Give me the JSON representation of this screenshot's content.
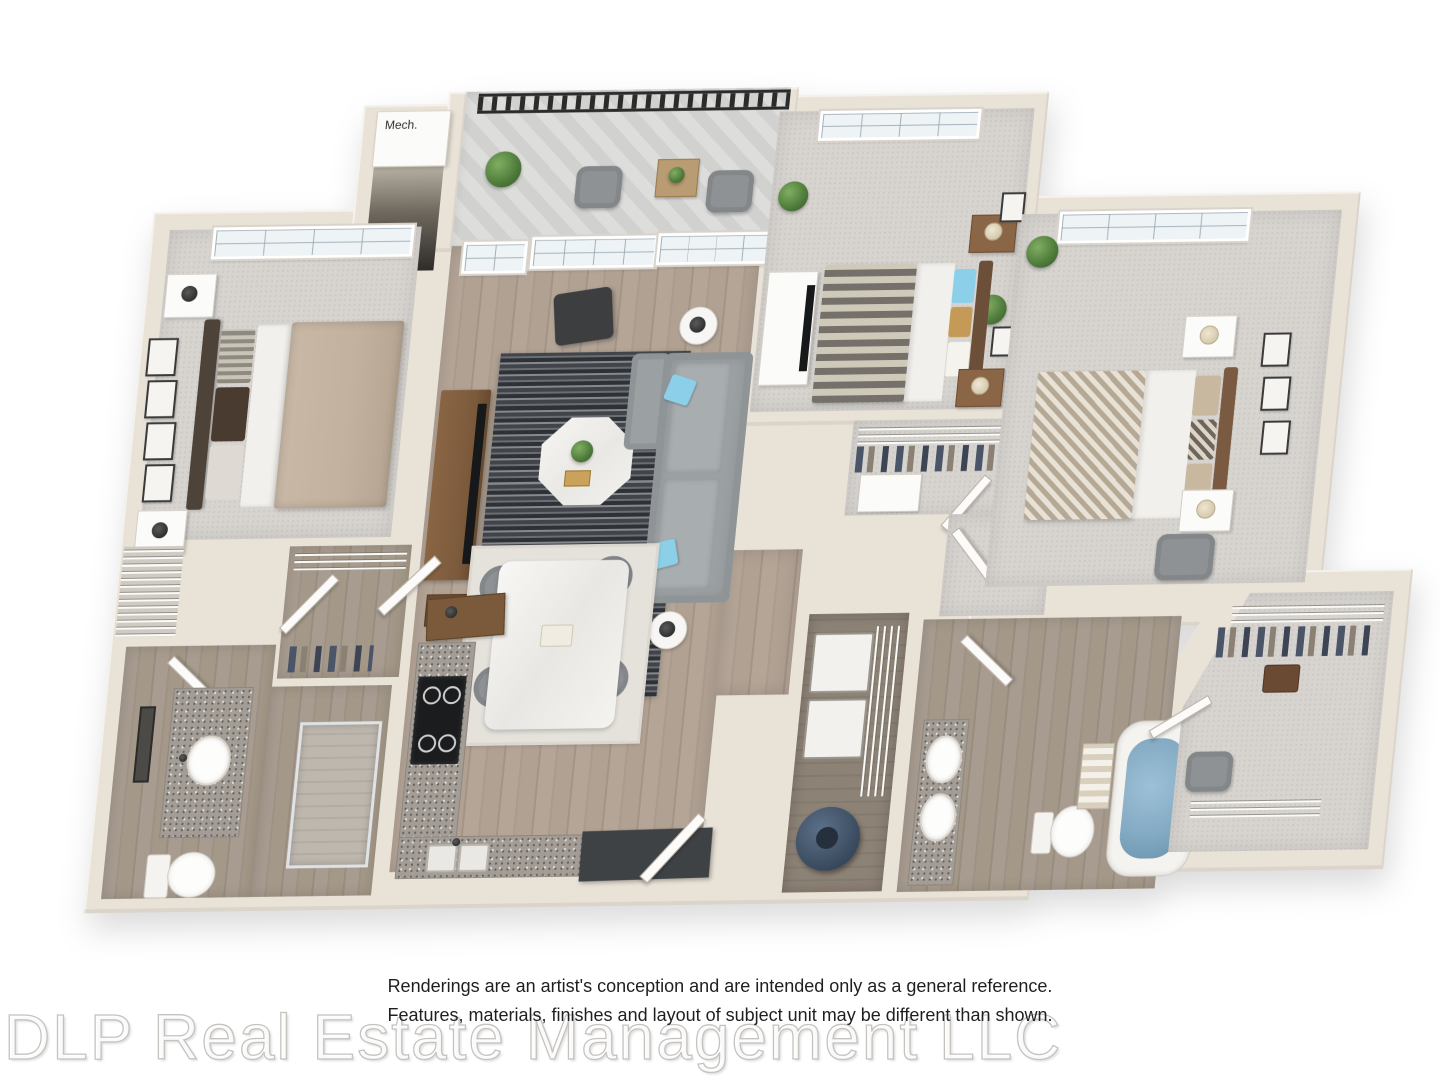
{
  "labels": {
    "mech": "Mech."
  },
  "footer": {
    "disclaimer_line1": "Renderings are an artist's conception and are intended only as a general reference.",
    "disclaimer_line2": "Features, materials, finishes and layout of subject unit may be different than shown.",
    "watermark": "DLP Real Estate Management LLC"
  },
  "colors": {
    "background": "#ffffff",
    "wall": "#e9e2d7",
    "carpet": "#d7d4d0",
    "hardwood": "#b0a192",
    "bath_floor": "#a89c90",
    "rug_dark": "#34373c",
    "sofa_gray": "#9ba0a3",
    "accent_blue": "#8ccfe8",
    "duvet_tan": "#c2b19e",
    "granite": "#a39d96",
    "tub_water": "#84abc4",
    "water_heater_navy": "#3e4f63",
    "railing_black": "#2b2b2b",
    "wood_furniture": "#7b5a3c"
  },
  "floorplan": {
    "type": "3d_isometric_floor_plan",
    "bedrooms": 3,
    "bathrooms": 2,
    "rooms": [
      {
        "id": "bedroom-1",
        "floor": "carpet",
        "contents": [
          "bed with tan duvet and gray headboard",
          "2 white nightstands with lamps",
          "4 framed prints on wall",
          "large grid window"
        ]
      },
      {
        "id": "living-room",
        "floor": "hardwood",
        "contents": [
          "gray sectional sofa",
          "light-blue accent pillows",
          "dark striped area rug",
          "white octagonal coffee table with plant",
          "wood media console with TV",
          "black lounge chair",
          "2 round side tables with black lamps",
          "french door to balcony",
          "grid windows"
        ]
      },
      {
        "id": "dining-area",
        "floor": "hardwood",
        "contents": [
          "white marble dining table",
          "4 gray chairs",
          "pale area rug"
        ]
      },
      {
        "id": "kitchen",
        "floor": "hardwood",
        "contents": [
          "L-shaped granite counter with white cabinets",
          "black range",
          "double sink",
          "wood coffee bar",
          "dark entry bench",
          "entry door"
        ]
      },
      {
        "id": "bedroom-2",
        "floor": "carpet",
        "contents": [
          "bed with chevron duvet",
          "blue and tan pillows",
          "wood nightstands with cream lamps",
          "white dresser with TV",
          "2 potted plants",
          "wall frames",
          "grid window"
        ]
      },
      {
        "id": "bedroom-3",
        "floor": "carpet",
        "contents": [
          "bed with herringbone duvet",
          "2 white nightstands with cream lamps",
          "3 wall frames",
          "gray accent chair",
          "potted plant",
          "grid window"
        ]
      },
      {
        "id": "bathroom-1",
        "floor": "wood-look",
        "contents": [
          "granite vanity with sink",
          "wall mirror",
          "toilet",
          "walk-in shower",
          "linen closet with wire shelves"
        ]
      },
      {
        "id": "bathroom-2",
        "floor": "wood-look",
        "contents": [
          "granite double vanity",
          "toilet",
          "soaking tub with water",
          "striped shower curtain"
        ]
      },
      {
        "id": "laundry-closet",
        "floor": "wood-look",
        "contents": [
          "washer",
          "dryer",
          "wire shelving",
          "navy water heater"
        ]
      },
      {
        "id": "walk-in-closet-bedroom-1",
        "contents": [
          "wire shelving",
          "hanging clothes",
          "door"
        ]
      },
      {
        "id": "hall-closet",
        "contents": [
          "wire shelf",
          "hanging clothes",
          "white dresser",
          "door"
        ]
      },
      {
        "id": "walk-in-closet-bedroom-3",
        "contents": [
          "wire shelving",
          "hanging clothes",
          "luggage",
          "diagonal entry"
        ]
      },
      {
        "id": "balcony",
        "floor": "deck-tiles",
        "contents": [
          "black metal railing",
          "2 gray outdoor chairs",
          "wood side table",
          "potted plants"
        ]
      },
      {
        "id": "mechanical-closet",
        "has_label": true
      }
    ]
  }
}
